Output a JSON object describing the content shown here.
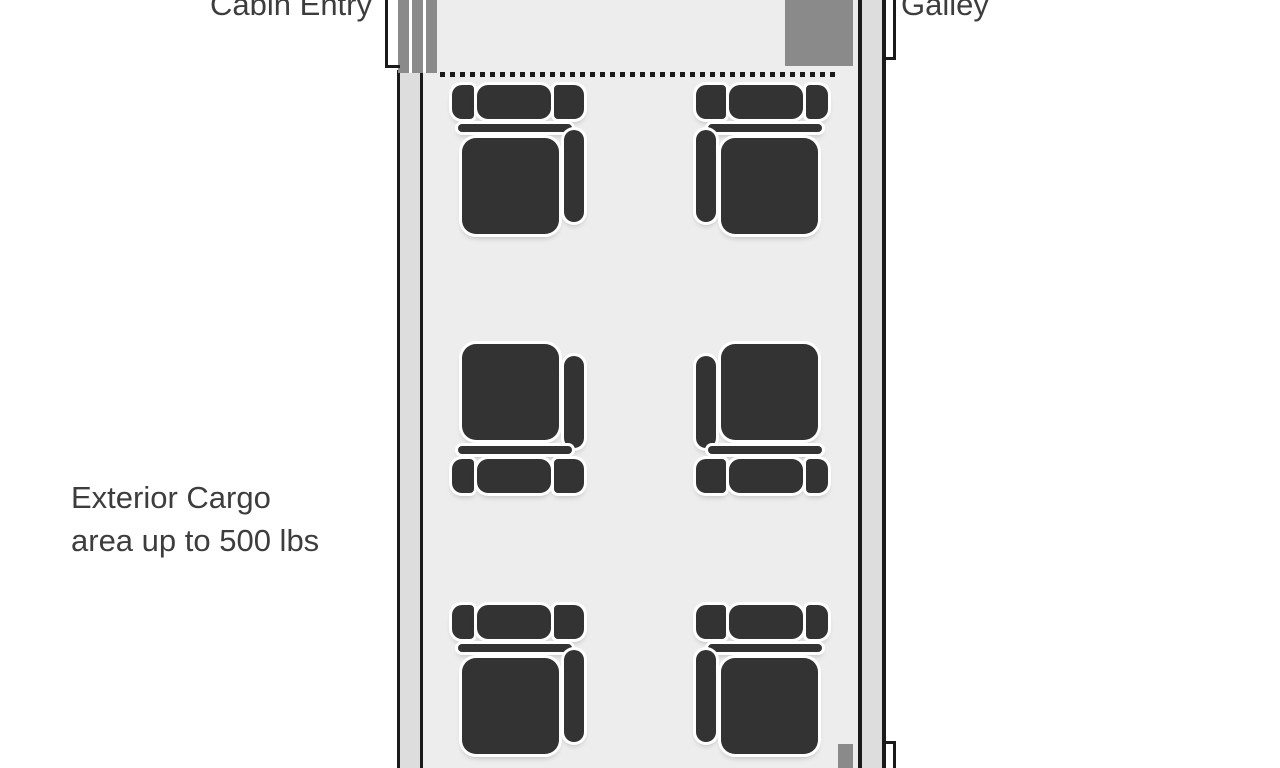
{
  "labels": {
    "cabin_entry": "Cabin Entry",
    "galley": "Galley",
    "exterior_cargo_line1": "Exterior Cargo",
    "exterior_cargo_line2": "area up to 500 lbs"
  },
  "cabin": {
    "type": "aircraft-cabin-floor-plan",
    "seat_count": 6,
    "rows": 3,
    "seats_per_row": 2,
    "seats": [
      {
        "id": "row1-left",
        "row": 1,
        "side": "left",
        "orientation": "headrest-top",
        "armrest": "aisle"
      },
      {
        "id": "row1-right",
        "row": 1,
        "side": "right",
        "orientation": "headrest-top",
        "armrest": "aisle"
      },
      {
        "id": "row2-left",
        "row": 2,
        "side": "left",
        "orientation": "headrest-bottom",
        "armrest": "aisle"
      },
      {
        "id": "row2-right",
        "row": 2,
        "side": "right",
        "orientation": "headrest-bottom",
        "armrest": "aisle"
      },
      {
        "id": "row3-left",
        "row": 3,
        "side": "left",
        "orientation": "headrest-top",
        "armrest": "aisle"
      },
      {
        "id": "row3-right",
        "row": 3,
        "side": "right",
        "orientation": "headrest-top",
        "armrest": "aisle"
      }
    ],
    "fixtures": [
      "cabin-entry-door-airstair",
      "galley-unit",
      "aft-door"
    ],
    "divider": "dotted-line-between-vestibule-and-cabin"
  },
  "colors": {
    "background": "#ffffff",
    "interior": "#ededed",
    "wall_band": "#dddddd",
    "outline": "#1a1a1a",
    "fixture_gray": "#8a8a8a",
    "seat": "#333333",
    "text": "#3d3d3d"
  }
}
